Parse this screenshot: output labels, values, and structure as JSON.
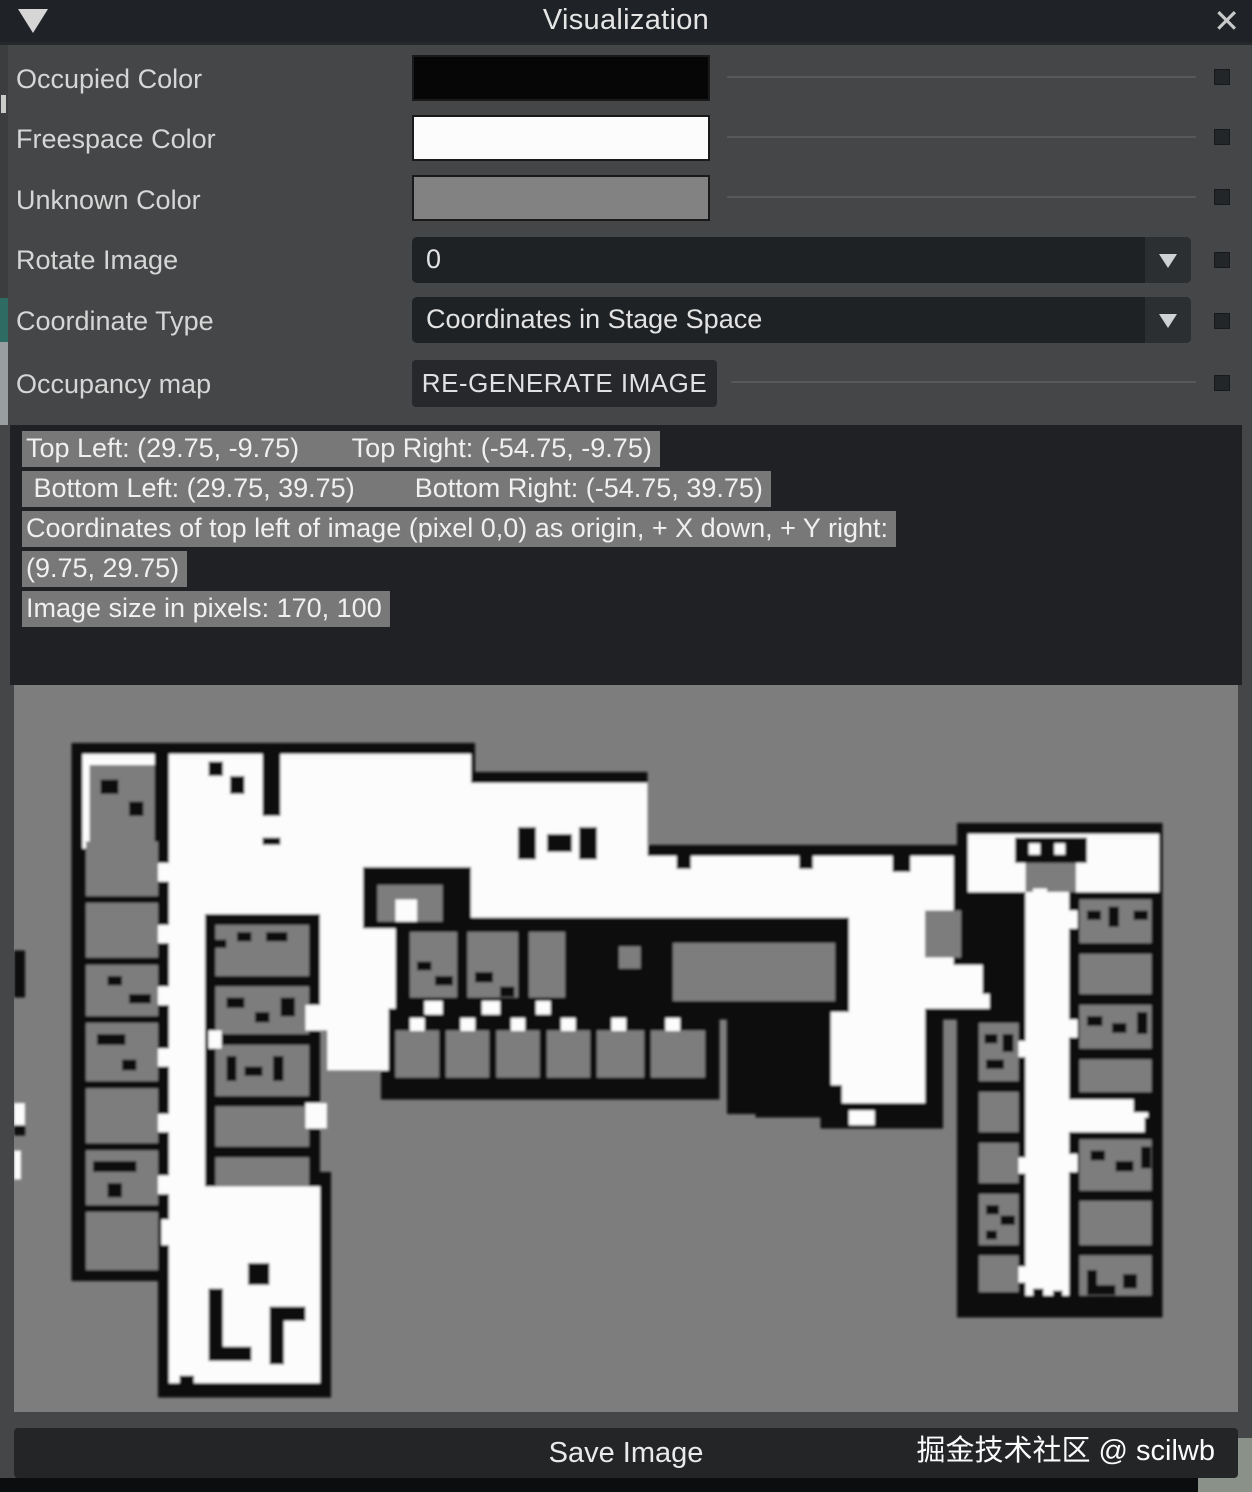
{
  "window": {
    "title": "Visualization",
    "collapse_icon": "triangle-down",
    "close_icon": "x"
  },
  "panel": {
    "rows": [
      {
        "label": "Occupied Color",
        "type": "color-swatch",
        "value": "#060606"
      },
      {
        "label": "Freespace Color",
        "type": "color-swatch",
        "value": "#fcfcfc"
      },
      {
        "label": "Unknown Color",
        "type": "color-swatch",
        "value": "#828282"
      },
      {
        "label": "Rotate Image",
        "type": "dropdown",
        "value": "0"
      },
      {
        "label": "Coordinate Type",
        "type": "dropdown",
        "value": "Coordinates in Stage Space"
      },
      {
        "label": "Occupancy map",
        "type": "button",
        "value": "RE-GENERATE IMAGE"
      }
    ]
  },
  "info": {
    "lines": [
      "Top Left: (29.75, -9.75)       Top Right: (-54.75, -9.75)",
      " Bottom Left: (29.75, 39.75)        Bottom Right: (-54.75, 39.75)",
      "Coordinates of top left of image (pixel 0,0) as origin, + X down, + Y right:",
      "(9.75, 29.75)",
      "Image size in pixels: 170, 100"
    ]
  },
  "map": {
    "kind": "occupancy-grid-image",
    "occupied_color": "#0c0c0c",
    "freespace_color": "#fcfcfc",
    "unknown_color": "#7d7d7d",
    "grid_width": 170,
    "grid_height": 100
  },
  "footer": {
    "save_label": "Save Image",
    "watermark": "掘金技术社区 @ scilwb"
  }
}
